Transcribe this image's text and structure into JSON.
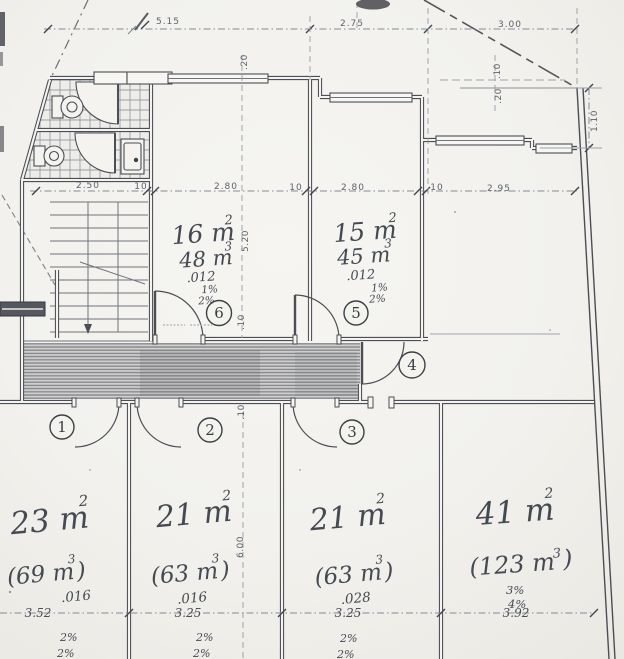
{
  "drawing": {
    "dims": {
      "top_515": "5.15",
      "top_275": "2.75",
      "top_300": "3.00",
      "wall_20_top": ".20",
      "offset_10": ".10",
      "offset_20": ".20",
      "right_110": "1.10",
      "mid_250": "2.50",
      "mid_10a": "10",
      "mid_280a": "2.80",
      "mid_10b": "10",
      "mid_280b": "2.80",
      "mid_10c": "10",
      "mid_295": "2.95",
      "vert_520": "5.20",
      "wall_10_room": ".10",
      "wall_10_corr": ".10",
      "vert_600": "6.00",
      "bot_352": "3.52",
      "bot_325a": "3.25",
      "bot_325b": "3.25",
      "bot_392": "3.92"
    },
    "rooms": {
      "room6": {
        "number": "6",
        "area": "16 m",
        "area_exp": "2",
        "volume": "48 m",
        "volume_exp": "3",
        "coef": ".012",
        "slope1": "1%",
        "slope2": "2%"
      },
      "room5": {
        "number": "5",
        "area": "15 m",
        "area_exp": "2",
        "volume": "45 m",
        "volume_exp": "3",
        "coef": ".012",
        "slope1": "1%",
        "slope2": "2%"
      },
      "hall4": {
        "number": "4"
      },
      "room1": {
        "number": "1",
        "area": "23 m",
        "area_exp": "2",
        "volume": "(69 m",
        "volume_exp": "3",
        "volume_close": ")",
        "coef": ".016",
        "slope1": "2%",
        "slope2": "2%"
      },
      "room2": {
        "number": "2",
        "area": "21 m",
        "area_exp": "2",
        "volume": "(63 m",
        "volume_exp": "3",
        "volume_close": ")",
        "coef": ".016",
        "slope1": "2%",
        "slope2": "2%"
      },
      "room3": {
        "number": "3",
        "area": "21 m",
        "area_exp": "2",
        "volume": "(63 m",
        "volume_exp": "3",
        "volume_close": ")",
        "coef": ".028",
        "slope1": "2%",
        "slope2": "2%"
      },
      "room_41": {
        "area": "41 m",
        "area_exp": "2",
        "volume": "(123 m",
        "volume_exp": "3",
        "volume_close": ")",
        "slope1": "3%",
        "slope2": "4%"
      }
    }
  }
}
